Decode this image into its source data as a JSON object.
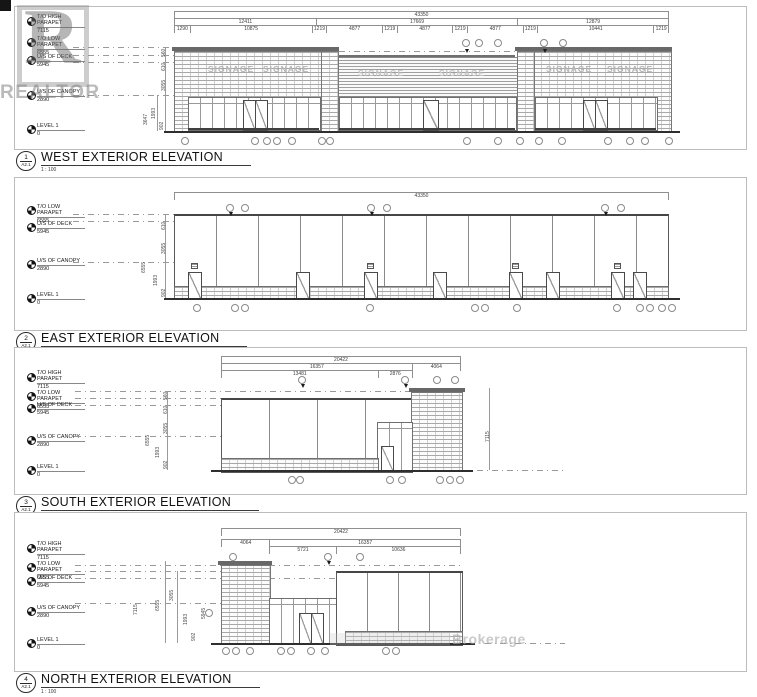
{
  "sheet": {
    "realtor_letter": "R",
    "realtor_word": "REALTOR",
    "brokerage_word": "Brokerage",
    "signage": "SIGNAGE",
    "line_color": "#5a5a5a",
    "cap_color": "#686868",
    "watermark_color": "#9a9a9a"
  },
  "levels": {
    "high": {
      "label": "T/O HIGH PARAPET",
      "value": "7115"
    },
    "low": {
      "label": "T/O LOW PARAPET",
      "value": "6555"
    },
    "deck": {
      "label": "U/S OF DECK",
      "value": "5945"
    },
    "canopy": {
      "label": "U/S OF CANOPY",
      "value": "2890"
    },
    "l1": {
      "label": "LEVEL 1",
      "value": "0"
    }
  },
  "views": {
    "west": {
      "num": "1",
      "sheet_ref": "A2.1",
      "title": "WEST EXTERIOR ELEVATION",
      "scale": "1 : 100",
      "dim_total": "43350",
      "row2": [
        "12411",
        "17669",
        "12879"
      ],
      "row3": [
        "1290",
        "10875",
        "1219",
        "4877",
        "1219",
        "4877",
        "1219",
        "4877",
        "1219",
        "10441",
        "1219"
      ],
      "vdims": [
        "560",
        "610",
        "3055",
        "3647",
        "1993",
        "902"
      ]
    },
    "east": {
      "num": "2",
      "sheet_ref": "A2.1",
      "title": "EAST EXTERIOR ELEVATION",
      "scale": "1 : 100",
      "dim_total": "43350",
      "vdims": [
        "610",
        "3055",
        "6555",
        "1993",
        "902"
      ]
    },
    "south": {
      "num": "3",
      "sheet_ref": "A2.1",
      "title": "SOUTH EXTERIOR ELEVATION",
      "scale": "1 : 100",
      "dim_total": "20422",
      "row2": [
        "16357",
        "4064"
      ],
      "row3": [
        "13481",
        "2876"
      ],
      "vdims": [
        "560",
        "610",
        "3055",
        "6555",
        "1993",
        "902"
      ],
      "vdim_right": "7115"
    },
    "north": {
      "num": "4",
      "sheet_ref": "A2.1",
      "title": "NORTH EXTERIOR ELEVATION",
      "scale": "1 : 100",
      "dim_total": "20422",
      "row2": [
        "4064",
        "16357"
      ],
      "row3": [
        "5721",
        "10636"
      ],
      "vdims": [
        "7115",
        "6555",
        "3055",
        "1993",
        "902",
        "5945"
      ]
    }
  }
}
